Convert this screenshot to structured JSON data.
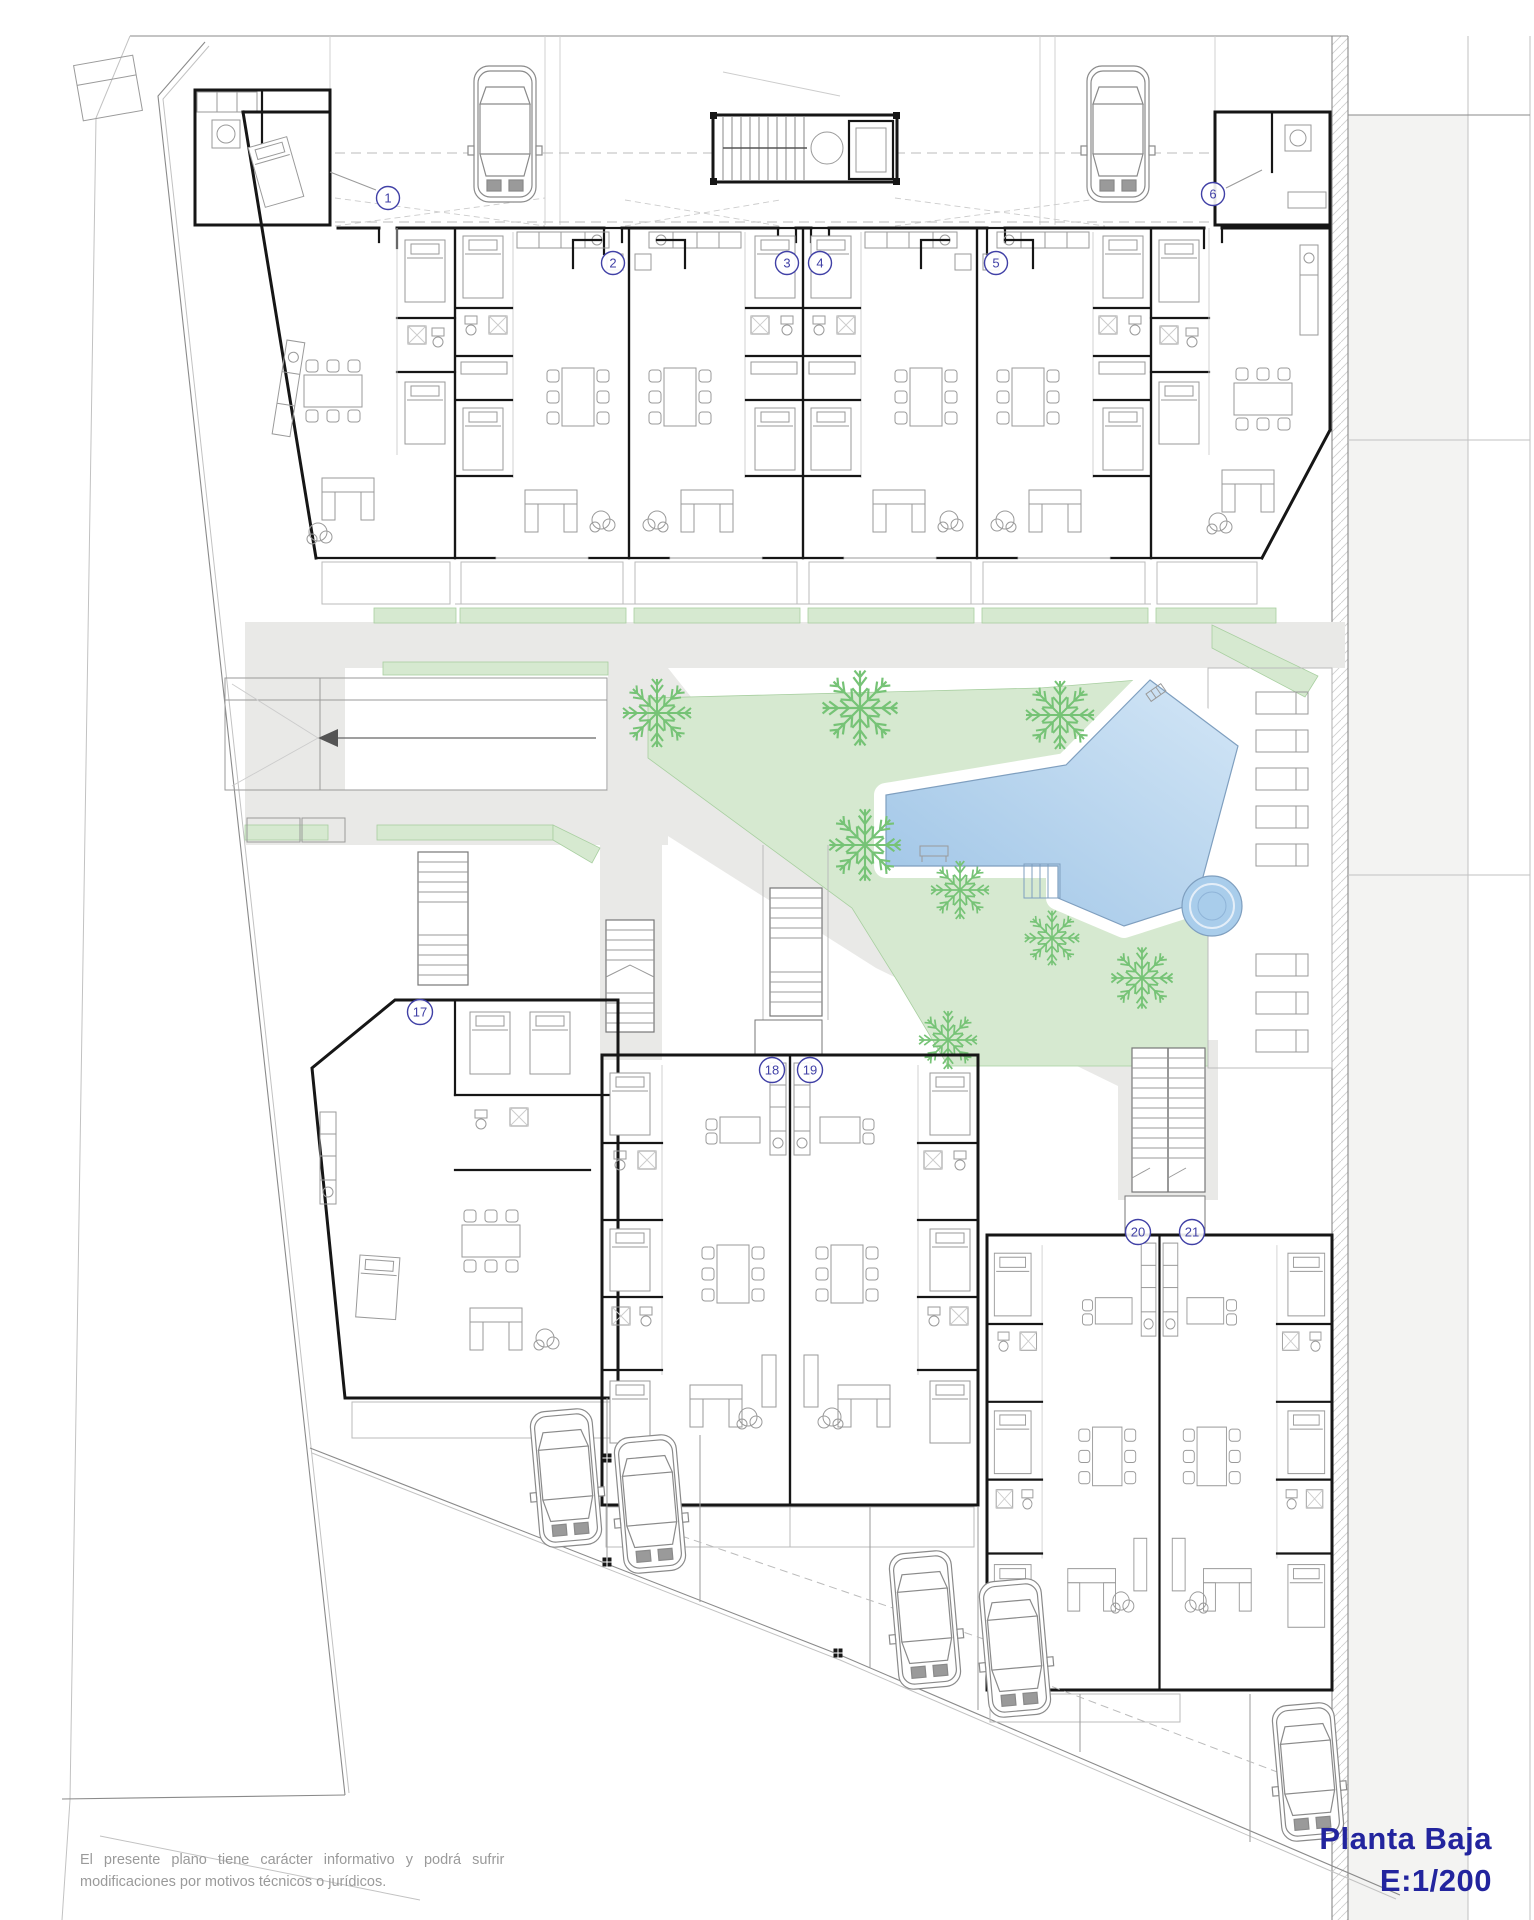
{
  "document": {
    "plan_title": "Planta Baja",
    "scale_label": "E:1/200"
  },
  "disclaimer": {
    "line1": "El presente plano tiene carácter informativo y podrá sufrir",
    "line2": "modificaciones por motivos técnicos o jurídicos."
  },
  "units": {
    "upper": [
      "1",
      "2",
      "3",
      "4",
      "5",
      "6"
    ],
    "lower": [
      "17",
      "18",
      "19",
      "20",
      "21"
    ]
  },
  "icons": {
    "car": "car-icon",
    "palm": "palm-tree-icon",
    "lounger": "sun-lounger-icon",
    "pool": "swimming-pool",
    "jacuzzi": "jacuzzi-icon",
    "stairs": "staircase-icon",
    "ramp_arrow": "ramp-arrow-icon"
  },
  "colors": {
    "wall": "#161616",
    "furn": "#9a9a9a",
    "path_gray": "#e9e9e7",
    "road_gray": "#f3f3f2",
    "garden_green": "#d6e9d0",
    "palm_green": "#76c376",
    "pool_edge": "#7f9fbf",
    "label_blue": "#4040a6",
    "title_blue": "#22249e",
    "disc_gray": "#9a9a9a"
  }
}
